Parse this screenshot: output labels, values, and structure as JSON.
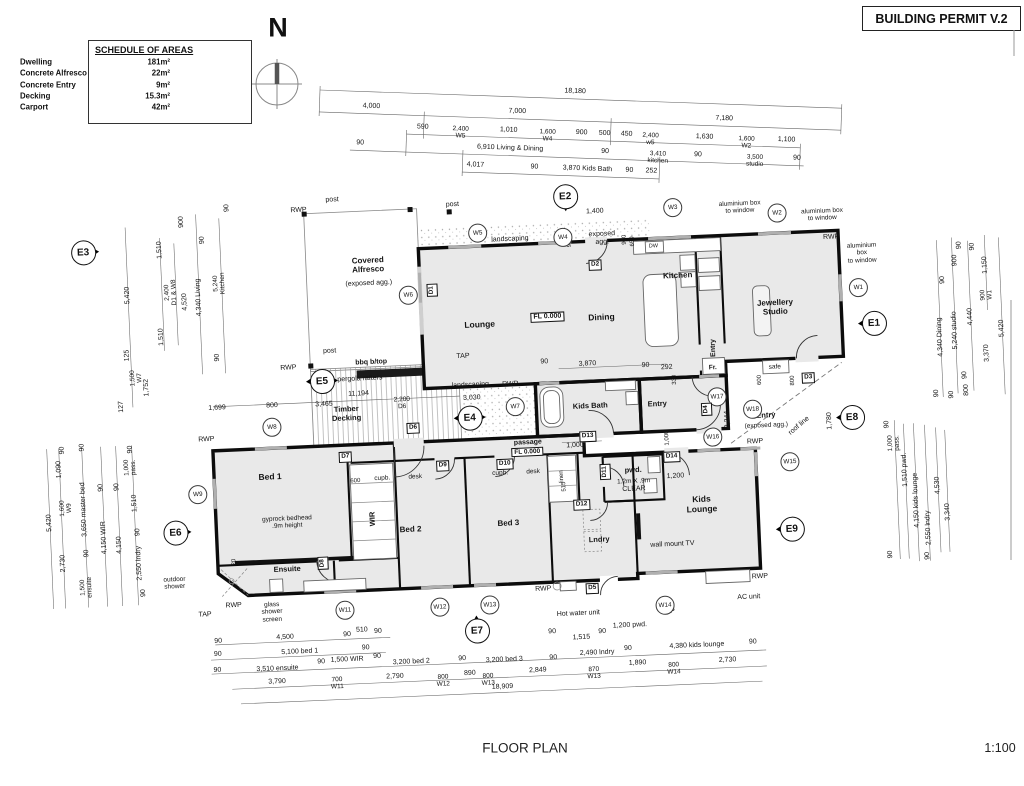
{
  "permit_label": "BUILDING PERMIT V.2",
  "north_letter": "N",
  "footer": {
    "title": "FLOOR PLAN",
    "scale": "1:100"
  },
  "colors": {
    "wall": "#0c0c0c",
    "room_fill": "#e9e9e9",
    "dim_line": "#666666",
    "window_mark": "#b0b0b0"
  },
  "schedule": {
    "title": "SCHEDULE OF AREAS",
    "rows": [
      {
        "label": "Dwelling",
        "value": "181m²"
      },
      {
        "label": "Concrete Alfresco",
        "value": "22m²"
      },
      {
        "label": "Concrete Entry",
        "value": "9m²"
      },
      {
        "label": "Decking",
        "value": "15.3m²"
      },
      {
        "label": "Carport",
        "value": "42m²"
      }
    ]
  },
  "top_dims": [
    {
      "t": "18,180",
      "x": 575,
      "y": 83
    },
    {
      "t": "4,000",
      "x": 372,
      "y": 105
    },
    {
      "t": "7,000",
      "x": 518,
      "y": 105
    },
    {
      "t": "7,180",
      "x": 725,
      "y": 105
    },
    {
      "t": "590",
      "x": 424,
      "y": 124
    },
    {
      "t": "2,400\nW5",
      "x": 462,
      "y": 128,
      "s": 6.5
    },
    {
      "t": "1,010",
      "x": 510,
      "y": 124
    },
    {
      "t": "1,600\nW4",
      "x": 549,
      "y": 128,
      "s": 6.5
    },
    {
      "t": "900",
      "x": 583,
      "y": 124
    },
    {
      "t": "500",
      "x": 606,
      "y": 124
    },
    {
      "t": "450",
      "x": 628,
      "y": 124
    },
    {
      "t": "2,400\nw5",
      "x": 652,
      "y": 128,
      "s": 6.5
    },
    {
      "t": "1,630",
      "x": 706,
      "y": 124
    },
    {
      "t": "1,600\nW2",
      "x": 748,
      "y": 128,
      "s": 6.5
    },
    {
      "t": "1,100",
      "x": 788,
      "y": 124
    },
    {
      "t": "90",
      "x": 362,
      "y": 142
    },
    {
      "t": "6,910 Living & Dining",
      "x": 512,
      "y": 142
    },
    {
      "t": "90",
      "x": 607,
      "y": 142
    },
    {
      "t": "3,410\nkitchen",
      "x": 660,
      "y": 146,
      "s": 6.5
    },
    {
      "t": "90",
      "x": 700,
      "y": 142
    },
    {
      "t": "3,500\nstudio",
      "x": 757,
      "y": 146,
      "s": 6.5
    },
    {
      "t": "90",
      "x": 799,
      "y": 142
    },
    {
      "t": "4,017",
      "x": 478,
      "y": 160
    },
    {
      "t": "90",
      "x": 537,
      "y": 160
    },
    {
      "t": "3,870 Kids Bath",
      "x": 590,
      "y": 160
    },
    {
      "t": "90",
      "x": 632,
      "y": 160
    },
    {
      "t": "252",
      "x": 654,
      "y": 160
    }
  ],
  "room_labels": [
    {
      "t": "Covered\nAlfresco",
      "x": 374,
      "y": 258,
      "b": 1,
      "s": 8
    },
    {
      "t": "(exposed agg.)",
      "x": 374,
      "y": 277,
      "s": 7
    },
    {
      "t": "Lounge",
      "x": 483,
      "y": 323,
      "b": 1,
      "s": 8.5
    },
    {
      "t": "Dining",
      "x": 605,
      "y": 321,
      "b": 1,
      "s": 8.5
    },
    {
      "t": "Kitchen",
      "x": 683,
      "y": 282,
      "b": 1,
      "s": 8
    },
    {
      "t": "Jewellery\nStudio",
      "x": 779,
      "y": 318,
      "b": 1,
      "s": 8
    },
    {
      "t": "Kids Bath",
      "x": 590,
      "y": 409,
      "b": 1,
      "s": 7.5
    },
    {
      "t": "Timber\nDecking",
      "x": 346,
      "y": 406,
      "b": 1,
      "s": 7.5
    },
    {
      "t": "Bed 1",
      "x": 267,
      "y": 466,
      "b": 1,
      "s": 8.5
    },
    {
      "t": "Bed 2",
      "x": 405,
      "y": 524,
      "b": 1,
      "s": 8
    },
    {
      "t": "Bed 3",
      "x": 503,
      "y": 522,
      "b": 1,
      "s": 8
    },
    {
      "t": "Ensuite",
      "x": 280,
      "y": 559,
      "b": 1,
      "s": 7.5
    },
    {
      "t": "WIR",
      "x": 368,
      "y": 512,
      "b": 1,
      "s": 7.5,
      "r": -90
    },
    {
      "t": "Lndry",
      "x": 593,
      "y": 543,
      "b": 1,
      "s": 7.5
    },
    {
      "t": "Kids\nLounge",
      "x": 697,
      "y": 512,
      "b": 1,
      "s": 8.5
    },
    {
      "t": "pwd.",
      "x": 630,
      "y": 475,
      "b": 1,
      "s": 7.5
    },
    {
      "t": "1.2m X .9m",
      "x": 630,
      "y": 486,
      "s": 6.5
    },
    {
      "t": "CLEAR",
      "x": 630,
      "y": 494,
      "s": 7
    },
    {
      "t": "passage",
      "x": 526,
      "y": 443,
      "b": 1,
      "s": 7
    },
    {
      "t": "FL 0.000",
      "x": 525,
      "y": 452,
      "box": 1,
      "s": 6.5
    },
    {
      "t": "FL 0.000",
      "x": 551,
      "y": 318,
      "box": 1,
      "s": 7
    },
    {
      "t": "Entry",
      "x": 657,
      "y": 410,
      "b": 1,
      "s": 7.5
    },
    {
      "t": "Entry",
      "x": 716,
      "y": 356,
      "b": 1,
      "s": 7,
      "r": -90
    },
    {
      "t": "Entry",
      "x": 765,
      "y": 426,
      "b": 1,
      "s": 7.5
    },
    {
      "t": "(exposed agg.)",
      "x": 765,
      "y": 436,
      "s": 6.5
    }
  ],
  "annotations": [
    {
      "t": "post",
      "x": 341,
      "y": 192
    },
    {
      "t": "post",
      "x": 461,
      "y": 202
    },
    {
      "t": "post",
      "x": 332,
      "y": 343
    },
    {
      "t": "RWP",
      "x": 307,
      "y": 201
    },
    {
      "t": "RWP",
      "x": 290,
      "y": 358
    },
    {
      "t": "RWP",
      "x": 205,
      "y": 426
    },
    {
      "t": "RWP",
      "x": 511,
      "y": 384
    },
    {
      "t": "RWP",
      "x": 838,
      "y": 251
    },
    {
      "t": "RWP",
      "x": 753,
      "y": 452
    },
    {
      "t": "RWP",
      "x": 225,
      "y": 593
    },
    {
      "t": "RWP",
      "x": 535,
      "y": 590
    },
    {
      "t": "RWP",
      "x": 752,
      "y": 587
    },
    {
      "t": "TAP",
      "x": 465,
      "y": 354
    },
    {
      "t": "TAP",
      "x": 196,
      "y": 601
    },
    {
      "t": "TAP",
      "x": 659,
      "y": 618
    },
    {
      "t": "landscaping",
      "x": 517,
      "y": 239
    },
    {
      "t": "landscaping",
      "x": 471,
      "y": 383
    },
    {
      "t": "bbq b/top",
      "x": 373,
      "y": 356,
      "b": 1
    },
    {
      "t": "pergola rafters",
      "x": 361,
      "y": 372
    },
    {
      "t": "exposed\nagg.",
      "x": 609,
      "y": 242
    },
    {
      "t": "aluminium box\nto window",
      "x": 748,
      "y": 217,
      "s": 6.5
    },
    {
      "t": "aluminium box\nto window",
      "x": 830,
      "y": 228,
      "s": 6.5
    },
    {
      "t": "aluminium\nbox\nto window",
      "x": 868,
      "y": 268,
      "s": 6.5
    },
    {
      "t": "DW",
      "x": 660,
      "y": 252,
      "s": 5.5
    },
    {
      "t": "gyprock bedhead\n.9m height",
      "x": 282,
      "y": 512,
      "s": 6.5
    },
    {
      "t": "glass\nshower\nscreen",
      "x": 263,
      "y": 601,
      "s": 6.5
    },
    {
      "t": "outdoor\nshower",
      "x": 167,
      "y": 568,
      "s": 6.5
    },
    {
      "t": "Hot water unit",
      "x": 569,
      "y": 616
    },
    {
      "t": "wall mount TV",
      "x": 666,
      "y": 551
    },
    {
      "t": "AC unit",
      "x": 740,
      "y": 607
    },
    {
      "t": "safe",
      "x": 776,
      "y": 378,
      "s": 6.5
    },
    {
      "t": "Fr.",
      "x": 714,
      "y": 376,
      "b": 1,
      "s": 6.5
    },
    {
      "t": "roof line",
      "x": 798,
      "y": 438,
      "r": -38
    },
    {
      "t": "linen",
      "x": 559,
      "y": 478,
      "r": -90,
      "s": 6
    },
    {
      "t": "cupb.",
      "x": 379,
      "y": 472,
      "s": 6.5
    },
    {
      "t": "desk",
      "x": 412,
      "y": 472,
      "s": 6.5
    },
    {
      "t": "cupb.",
      "x": 497,
      "y": 472,
      "s": 6.5
    },
    {
      "t": "desk",
      "x": 530,
      "y": 472,
      "s": 6.5
    }
  ],
  "dim_labels": [
    {
      "t": "4,500",
      "x": 275,
      "y": 627
    },
    {
      "t": "90",
      "x": 208,
      "y": 628
    },
    {
      "t": "90",
      "x": 337,
      "y": 627
    },
    {
      "t": "510",
      "x": 352,
      "y": 623
    },
    {
      "t": "90",
      "x": 368,
      "y": 625
    },
    {
      "t": "5,100 bed 1",
      "x": 289,
      "y": 642
    },
    {
      "t": "90",
      "x": 207,
      "y": 641
    },
    {
      "t": "90",
      "x": 355,
      "y": 641
    },
    {
      "t": "3,510 ensuite",
      "x": 266,
      "y": 658
    },
    {
      "t": "90",
      "x": 206,
      "y": 657
    },
    {
      "t": "90",
      "x": 310,
      "y": 653
    },
    {
      "t": "1,500 WIR",
      "x": 336,
      "y": 652
    },
    {
      "t": "90",
      "x": 366,
      "y": 650
    },
    {
      "t": "3,200 bed 2",
      "x": 400,
      "y": 657
    },
    {
      "t": "90",
      "x": 451,
      "y": 656
    },
    {
      "t": "3,200 bed 3",
      "x": 493,
      "y": 659
    },
    {
      "t": "90",
      "x": 542,
      "y": 659
    },
    {
      "t": "2,490 lndry",
      "x": 586,
      "y": 656
    },
    {
      "t": "90",
      "x": 617,
      "y": 653
    },
    {
      "t": "1,515",
      "x": 571,
      "y": 640
    },
    {
      "t": "90",
      "x": 542,
      "y": 633
    },
    {
      "t": "90",
      "x": 592,
      "y": 635
    },
    {
      "t": "1,200 pwd.",
      "x": 620,
      "y": 630
    },
    {
      "t": "4,380 kids lounge",
      "x": 686,
      "y": 653
    },
    {
      "t": "90",
      "x": 742,
      "y": 652
    },
    {
      "t": "3,790",
      "x": 265,
      "y": 671
    },
    {
      "t": "700\nW11",
      "x": 325,
      "y": 675,
      "s": 6.5
    },
    {
      "t": "2,790",
      "x": 383,
      "y": 671
    },
    {
      "t": "800\nW12",
      "x": 431,
      "y": 677,
      "s": 6.5
    },
    {
      "t": "890",
      "x": 458,
      "y": 671
    },
    {
      "t": "800\nW13",
      "x": 476,
      "y": 678,
      "s": 6.5
    },
    {
      "t": "2,849",
      "x": 526,
      "y": 671
    },
    {
      "t": "870\nW13",
      "x": 582,
      "y": 676,
      "s": 6.5
    },
    {
      "t": "1,890",
      "x": 626,
      "y": 668
    },
    {
      "t": "800\nW14",
      "x": 662,
      "y": 675,
      "s": 6.5
    },
    {
      "t": "2,730",
      "x": 716,
      "y": 669
    },
    {
      "t": "18,909",
      "x": 490,
      "y": 686
    },
    {
      "t": "5,420",
      "x": 45,
      "y": 502,
      "r": -90
    },
    {
      "t": "1,090",
      "x": 57,
      "y": 449,
      "r": -90
    },
    {
      "t": "1,600\nW9",
      "x": 62,
      "y": 488,
      "r": -90,
      "s": 6.5
    },
    {
      "t": "2,730",
      "x": 57,
      "y": 543,
      "r": -90
    },
    {
      "t": "90",
      "x": 61,
      "y": 430,
      "r": -90
    },
    {
      "t": "90",
      "x": 81,
      "y": 428,
      "r": -90
    },
    {
      "t": "3,650 master bed",
      "x": 80,
      "y": 490,
      "r": -90
    },
    {
      "t": "90",
      "x": 81,
      "y": 534,
      "r": -90
    },
    {
      "t": "1,500\nensuite",
      "x": 79,
      "y": 568,
      "r": -90,
      "s": 6.5
    },
    {
      "t": "4,150 WIR",
      "x": 99,
      "y": 519,
      "r": -90
    },
    {
      "t": "90",
      "x": 98,
      "y": 469,
      "r": -90
    },
    {
      "t": "4,150",
      "x": 114,
      "y": 527,
      "r": -90
    },
    {
      "t": "90",
      "x": 114,
      "y": 469,
      "r": -90
    },
    {
      "t": "1,000\npass.",
      "x": 128,
      "y": 450,
      "r": -90,
      "s": 6.5
    },
    {
      "t": "90",
      "x": 129,
      "y": 432,
      "r": -90
    },
    {
      "t": "1,510",
      "x": 131,
      "y": 486,
      "r": -90
    },
    {
      "t": "90",
      "x": 133,
      "y": 515,
      "r": -90
    },
    {
      "t": "2,550 lndry",
      "x": 133,
      "y": 546,
      "r": -90
    },
    {
      "t": "90",
      "x": 136,
      "y": 576,
      "r": -90
    },
    {
      "t": "5,420",
      "x": 133,
      "y": 278,
      "r": -90
    },
    {
      "t": "1,510",
      "x": 167,
      "y": 234,
      "r": -90
    },
    {
      "t": "2,400\nD1 & W8",
      "x": 176,
      "y": 277,
      "r": -90,
      "s": 6.5
    },
    {
      "t": "1,510",
      "x": 165,
      "y": 321,
      "r": -90
    },
    {
      "t": "4,520",
      "x": 190,
      "y": 287,
      "r": -90
    },
    {
      "t": "900",
      "x": 190,
      "y": 207,
      "r": -90
    },
    {
      "t": "90",
      "x": 236,
      "y": 195,
      "r": -90
    },
    {
      "t": "90",
      "x": 210,
      "y": 226,
      "r": -90
    },
    {
      "t": "4,340 Living",
      "x": 204,
      "y": 283,
      "r": -90
    },
    {
      "t": "5,240\nKitchen",
      "x": 225,
      "y": 270,
      "r": -90,
      "s": 6.5
    },
    {
      "t": "90",
      "x": 220,
      "y": 344,
      "r": -90
    },
    {
      "t": "125",
      "x": 130,
      "y": 338,
      "r": -90
    },
    {
      "t": "1,500\nW7",
      "x": 138,
      "y": 361,
      "r": -90,
      "s": 6.5
    },
    {
      "t": "1,752",
      "x": 148,
      "y": 371,
      "r": -90
    },
    {
      "t": "127",
      "x": 122,
      "y": 389,
      "r": -90
    },
    {
      "t": "90",
      "x": 966,
      "y": 264,
      "r": -90
    },
    {
      "t": "90",
      "x": 979,
      "y": 266,
      "r": -90
    },
    {
      "t": "900",
      "x": 961,
      "y": 279,
      "r": -90
    },
    {
      "t": "90",
      "x": 948,
      "y": 298,
      "r": -90
    },
    {
      "t": "1,150",
      "x": 991,
      "y": 285,
      "r": -90
    },
    {
      "t": "900\nW1",
      "x": 991,
      "y": 315,
      "r": -90,
      "s": 6.5
    },
    {
      "t": "4,340 Dining",
      "x": 943,
      "y": 355,
      "r": -90
    },
    {
      "t": "5,240 studio",
      "x": 958,
      "y": 349,
      "r": -90
    },
    {
      "t": "4,440",
      "x": 974,
      "y": 336,
      "r": -90
    },
    {
      "t": "5,420",
      "x": 1005,
      "y": 349,
      "r": -90
    },
    {
      "t": "3,370",
      "x": 989,
      "y": 373,
      "r": -90
    },
    {
      "t": "90",
      "x": 966,
      "y": 394,
      "r": -90
    },
    {
      "t": "90",
      "x": 937,
      "y": 411,
      "r": -90
    },
    {
      "t": "90",
      "x": 952,
      "y": 413,
      "r": -90
    },
    {
      "t": "800",
      "x": 967,
      "y": 409,
      "r": -90
    },
    {
      "t": "90",
      "x": 886,
      "y": 440,
      "r": -90
    },
    {
      "t": "1,000\npass.",
      "x": 892,
      "y": 459,
      "r": -90,
      "s": 6.5
    },
    {
      "t": "1,510 pwd.",
      "x": 902,
      "y": 486,
      "r": -90
    },
    {
      "t": "4,150 kids lounge",
      "x": 912,
      "y": 517,
      "r": -90
    },
    {
      "t": "2,550 lndry",
      "x": 923,
      "y": 545,
      "r": -90
    },
    {
      "t": "4,530",
      "x": 934,
      "y": 503,
      "r": -90
    },
    {
      "t": "3,340",
      "x": 943,
      "y": 530,
      "r": -90
    },
    {
      "t": "90",
      "x": 884,
      "y": 570,
      "r": -90
    },
    {
      "t": "90",
      "x": 921,
      "y": 573,
      "r": -90
    },
    {
      "t": "1,699",
      "x": 217,
      "y": 395
    },
    {
      "t": "800",
      "x": 272,
      "y": 395
    },
    {
      "t": "3,465",
      "x": 324,
      "y": 396
    },
    {
      "t": "11,194",
      "x": 359,
      "y": 387
    },
    {
      "t": "2,200\nD6",
      "x": 402,
      "y": 398,
      "s": 6.5
    },
    {
      "t": "3,030",
      "x": 472,
      "y": 396
    },
    {
      "t": "1,400",
      "x": 603,
      "y": 215
    },
    {
      "t": "900",
      "x": 577,
      "y": 244,
      "r": -90,
      "s": 6
    },
    {
      "t": "900",
      "x": 632,
      "y": 244,
      "r": -90,
      "s": 6
    },
    {
      "t": "650",
      "x": 640,
      "y": 246,
      "r": -90,
      "s": 6
    },
    {
      "t": "90",
      "x": 546,
      "y": 363
    },
    {
      "t": "3,870",
      "x": 589,
      "y": 367
    },
    {
      "t": "90",
      "x": 647,
      "y": 371
    },
    {
      "t": "292",
      "x": 668,
      "y": 374
    },
    {
      "t": "330",
      "x": 676,
      "y": 386,
      "r": -90,
      "s": 6
    },
    {
      "t": "600",
      "x": 761,
      "y": 390,
      "r": -90,
      "s": 6
    },
    {
      "t": "800",
      "x": 794,
      "y": 392,
      "r": -90,
      "s": 6
    },
    {
      "t": "1,000",
      "x": 666,
      "y": 444,
      "r": -90,
      "s": 6
    },
    {
      "t": "2,244",
      "x": 727,
      "y": 428,
      "r": -90
    },
    {
      "t": "1,780",
      "x": 829,
      "y": 434,
      "r": -90
    },
    {
      "t": "1,200",
      "x": 672,
      "y": 483
    },
    {
      "t": "1,000",
      "x": 573,
      "y": 448
    },
    {
      "t": "600",
      "x": 352,
      "y": 474,
      "s": 6
    },
    {
      "t": "515",
      "x": 561,
      "y": 488,
      "r": -90,
      "s": 6
    },
    {
      "t": "20",
      "x": 228,
      "y": 549,
      "r": -90,
      "s": 6
    }
  ],
  "window_bubbles": [
    {
      "t": "W1",
      "x": 863,
      "y": 302
    },
    {
      "t": "W2",
      "x": 785,
      "y": 224
    },
    {
      "t": "W3",
      "x": 681,
      "y": 214
    },
    {
      "t": "W4",
      "x": 570,
      "y": 239
    },
    {
      "t": "W5",
      "x": 485,
      "y": 231
    },
    {
      "t": "W6",
      "x": 413,
      "y": 290
    },
    {
      "t": "W7",
      "x": 515,
      "y": 406
    },
    {
      "t": "W8",
      "x": 271,
      "y": 416
    },
    {
      "t": "W9",
      "x": 194,
      "y": 480
    },
    {
      "t": "W11",
      "x": 336,
      "y": 602
    },
    {
      "t": "W12",
      "x": 431,
      "y": 603
    },
    {
      "t": "W13",
      "x": 481,
      "y": 603
    },
    {
      "t": "W14",
      "x": 656,
      "y": 611
    },
    {
      "t": "W15",
      "x": 787,
      "y": 473
    },
    {
      "t": "W16",
      "x": 711,
      "y": 445
    },
    {
      "t": "W17",
      "x": 717,
      "y": 405
    },
    {
      "t": "W18",
      "x": 752,
      "y": 419
    }
  ],
  "door_tags": [
    {
      "t": "D1",
      "x": 437,
      "y": 286,
      "r": -90
    },
    {
      "t": "D2",
      "x": 601,
      "y": 268
    },
    {
      "t": "D3",
      "x": 809,
      "y": 390
    },
    {
      "t": "D4",
      "x": 706,
      "y": 417,
      "r": -90
    },
    {
      "t": "D5",
      "x": 584,
      "y": 591
    },
    {
      "t": "D6",
      "x": 412,
      "y": 423
    },
    {
      "t": "D7",
      "x": 343,
      "y": 449
    },
    {
      "t": "D8",
      "x": 316,
      "y": 554,
      "r": -90
    },
    {
      "t": "D9",
      "x": 440,
      "y": 462
    },
    {
      "t": "D10",
      "x": 502,
      "y": 463
    },
    {
      "t": "D11",
      "x": 602,
      "y": 475,
      "r": -90
    },
    {
      "t": "D12",
      "x": 577,
      "y": 507
    },
    {
      "t": "D13",
      "x": 586,
      "y": 439
    },
    {
      "t": "D14",
      "x": 669,
      "y": 463
    }
  ],
  "elevation_markers": [
    {
      "t": "E1",
      "x": 877,
      "y": 338,
      "dir": "left"
    },
    {
      "t": "E2",
      "x": 574,
      "y": 198,
      "dir": "down"
    },
    {
      "t": "E3",
      "x": 90,
      "y": 233,
      "dir": "right"
    },
    {
      "t": "E4",
      "x": 469,
      "y": 415,
      "dir": "both"
    },
    {
      "t": "E5",
      "x": 323,
      "y": 372,
      "dir": "both"
    },
    {
      "t": "E6",
      "x": 170,
      "y": 517,
      "dir": "right"
    },
    {
      "t": "E7",
      "x": 467,
      "y": 628,
      "dir": "up"
    },
    {
      "t": "E8",
      "x": 851,
      "y": 431,
      "dir": "left"
    },
    {
      "t": "E9",
      "x": 786,
      "y": 540,
      "dir": "left"
    }
  ]
}
